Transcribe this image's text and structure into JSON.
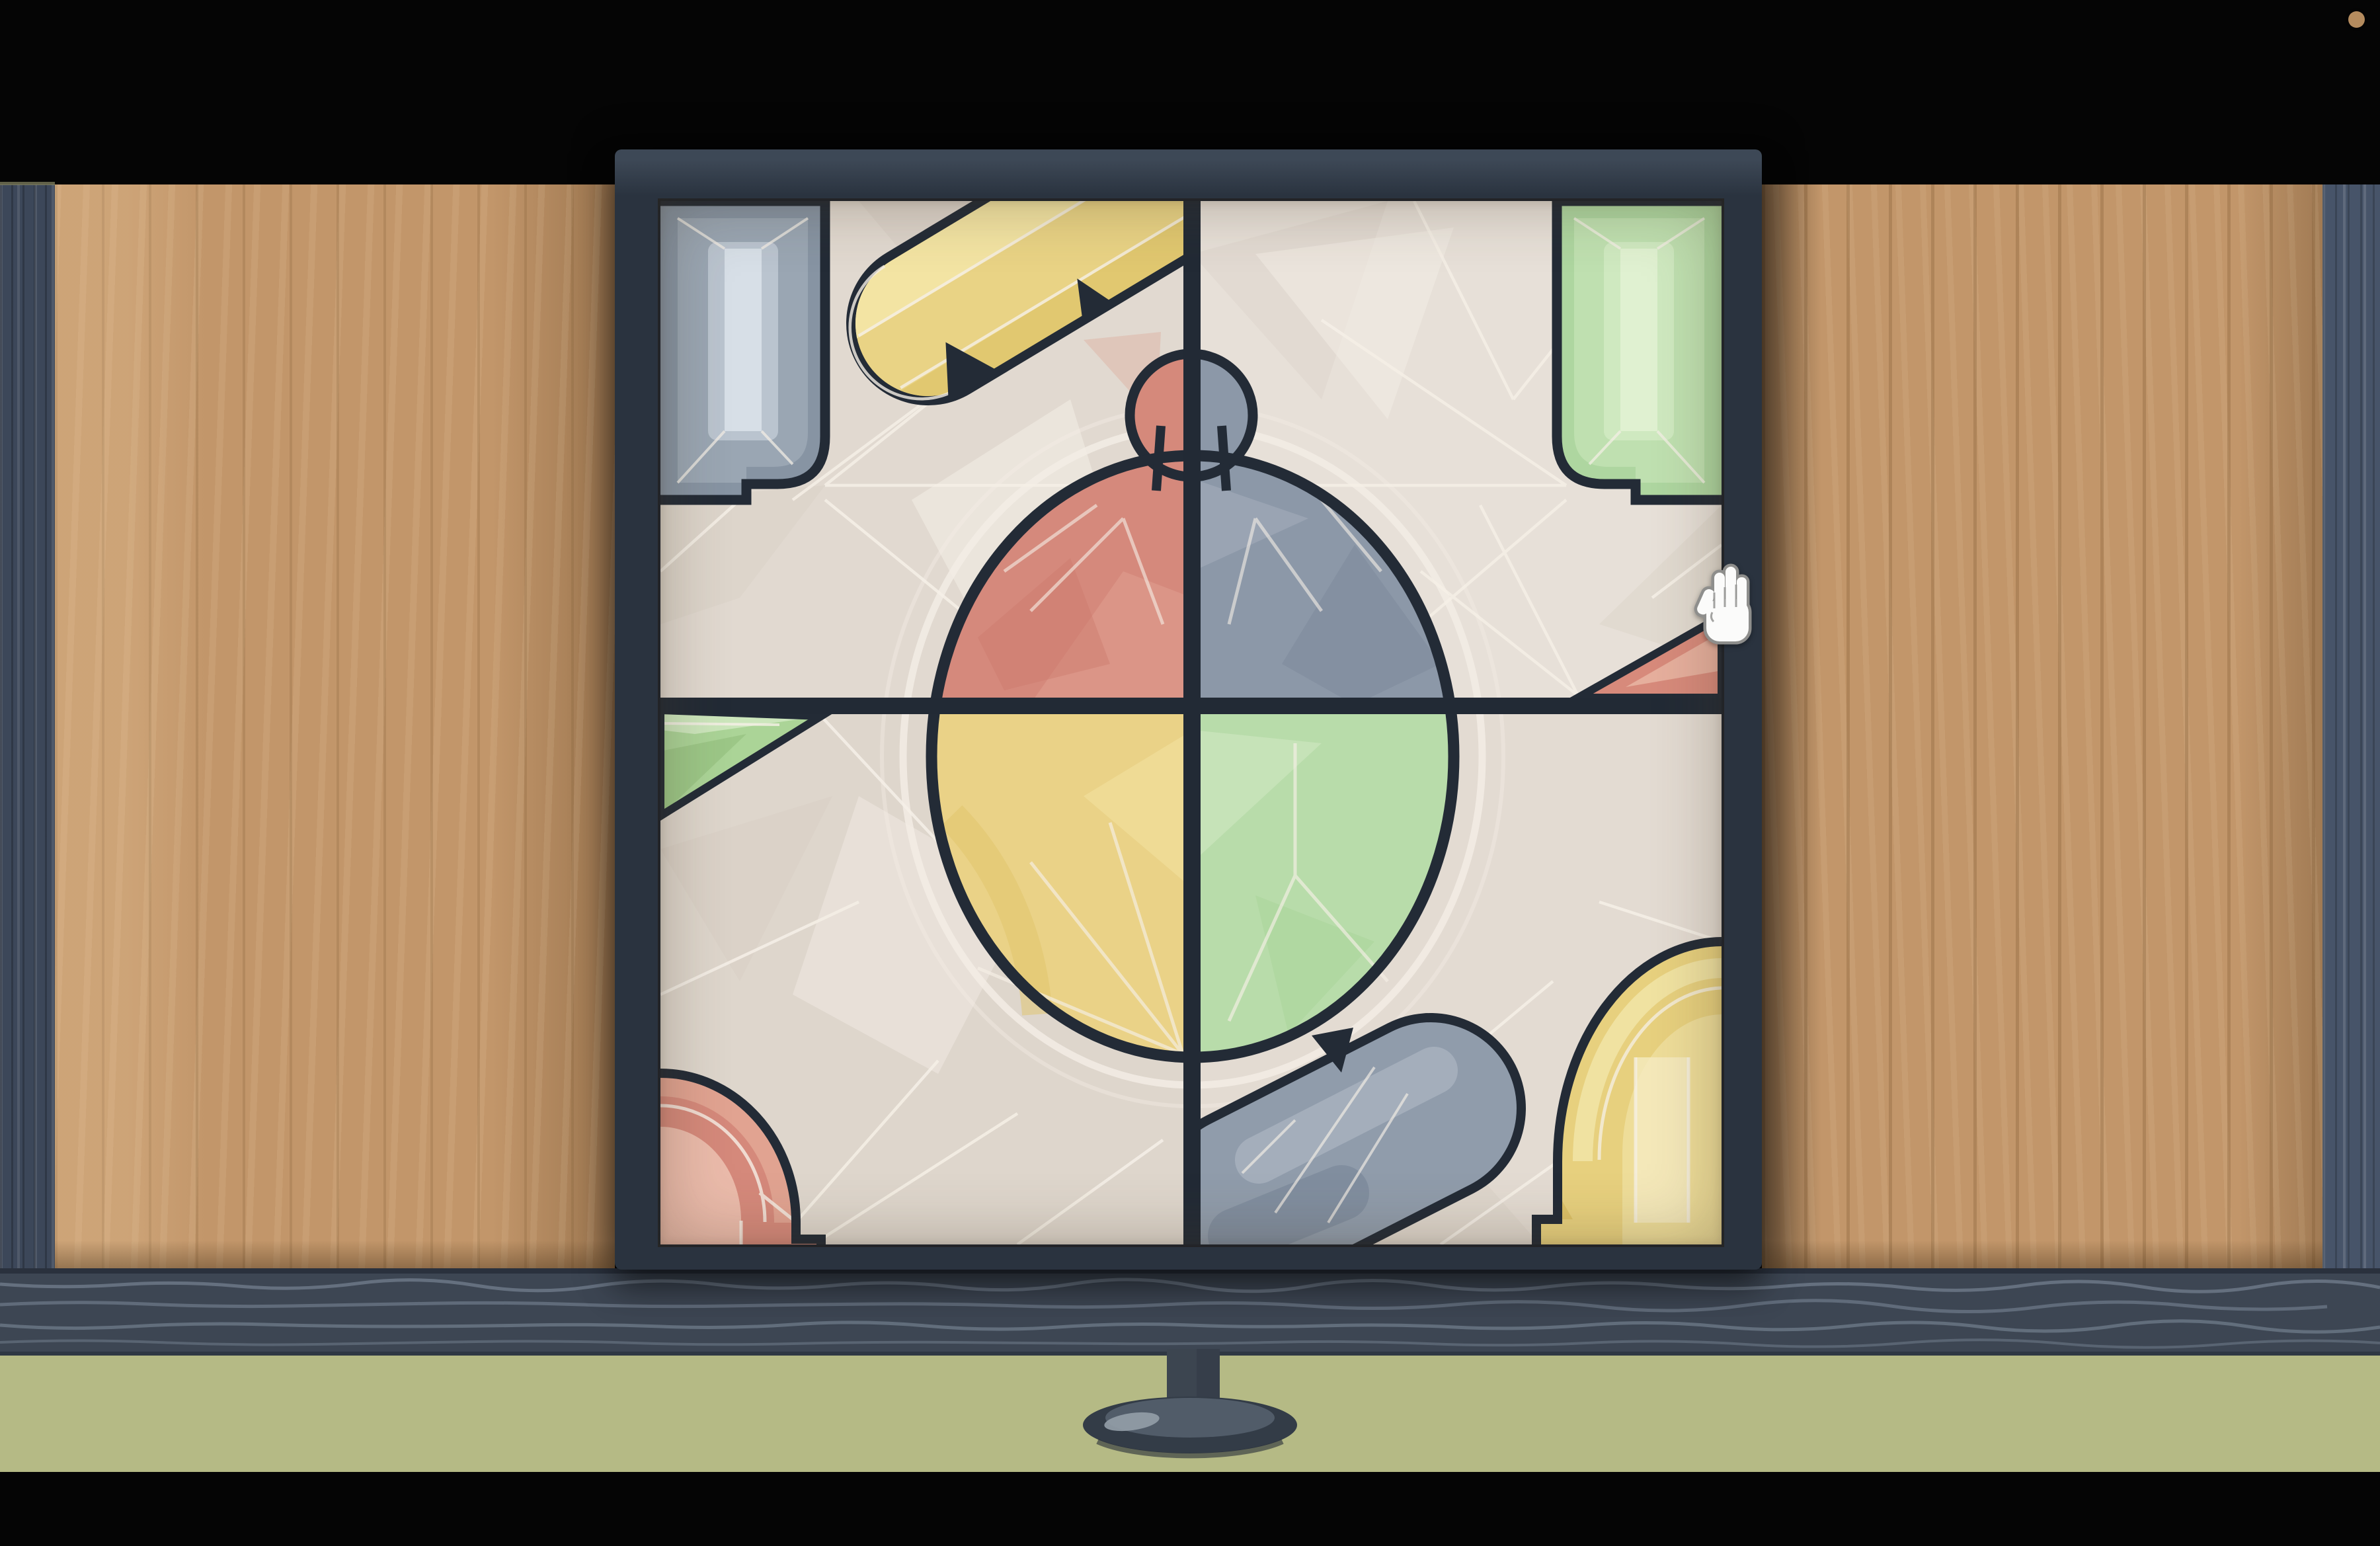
{
  "meta": {
    "app": "puzzle-game",
    "scene": "wooden-cabinet-sliding-panel-stained-glass-puzzle",
    "visible_text": [],
    "cursor": {
      "type": "open-hand",
      "location": "right-frame-edge"
    }
  },
  "colors": {
    "bg_black": "#050505",
    "wall_left": "#3c4759",
    "wall_right": "#475469",
    "wall_accent": "#8a8a66",
    "wood": "#c2966a",
    "table": "#3d4653",
    "table_grain": "#6c7887",
    "table_edge": "#272e39",
    "floor_olive": "#b5ba85",
    "frame": "#2a333f",
    "frame_light": "#3d4856",
    "frame_dark": "#1b222c",
    "bar": "#222a35",
    "outline": "#232b36",
    "bg_tl": "#e1d9d0",
    "bg_tr": "#e7e0d8",
    "bg_bl": "#ded6cc",
    "bg_br": "#e3dbd2",
    "facet_line": "#f6f0e7",
    "facet_light": "#f4eee6",
    "facet_shade": "#cbc1b5",
    "red_q": "#d5897c",
    "red_q_light": "#e2a292",
    "red_q_dark": "#cb7a6c",
    "gray_q": "#8c98a8",
    "gray_q_light": "#aab4c1",
    "gray_q_dark": "#7b8899",
    "yellow_q": "#ead287",
    "yellow_q_light": "#f2e2a1",
    "yellow_q_dark": "#dfc36a",
    "green_q": "#b8dcaa",
    "green_q_light": "#d3eac5",
    "green_q_dark": "#a6d193",
    "gem_gray_1": "#8794a3",
    "gem_gray_2": "#9aa6b3",
    "gem_gray_3": "#bac4cf",
    "gem_gray_4": "#d7dfe7",
    "gem_green_1": "#aed6a0",
    "gem_green_2": "#bfe0b0",
    "gem_green_3": "#cfe9c0",
    "gem_green_4": "#e0f1d1",
    "cap_yellow_1": "#e9d385",
    "cap_yellow_2": "#f3e4a3",
    "cap_yellow_3": "#dfc66c",
    "cap_gray_1": "#909cab",
    "cap_gray_2": "#a9b3c0",
    "cap_gray_3": "#7d8a9b",
    "arch_red_1": "#d5897b",
    "arch_red_2": "#e2a694",
    "arch_red_3": "#eec4b4",
    "arch_yellow_1": "#e7d07e",
    "arch_yellow_2": "#f1e3a5",
    "arch_yellow_3": "#dcc167",
    "arch_yellow_4": "#f5ebc0",
    "wedge_green_1": "#abd497",
    "wedge_green_2": "#cfe8c0",
    "wedge_green_3": "#98c383",
    "tri_red_1": "#d78a7b",
    "tri_red_2": "#e9b5a3",
    "sliver_red": "#dfb6a8",
    "knob_red": "#d5897b",
    "knob_gray": "#8c98a8",
    "ped_dark": "#333c47",
    "ped_mid": "#3c4550",
    "ped_top": "#515c69",
    "ped_hi": "#939ea9",
    "hand_fill": "#fbfbfa",
    "hand_line": "#8e8e8c",
    "dot": "#b48b5e"
  },
  "puzzle": {
    "rows": 2,
    "cols": 2,
    "panels": [
      {
        "id": "top-left",
        "shapes": [
          "gray-gem",
          "yellow-capsule",
          "red-circle-quadrant",
          "red-knob-half"
        ]
      },
      {
        "id": "top-right",
        "shapes": [
          "green-gem",
          "gray-circle-quadrant",
          "gray-knob-half",
          "red-corner-triangle"
        ]
      },
      {
        "id": "bottom-left",
        "shapes": [
          "green-wedge",
          "yellow-circle-quadrant",
          "red-arch"
        ]
      },
      {
        "id": "bottom-right",
        "shapes": [
          "green-circle-quadrant",
          "gray-capsule",
          "yellow-arch"
        ]
      }
    ]
  },
  "scene": {
    "left_wall": "dark blue wall strip",
    "right_wall": "dark blue wall strip",
    "left_wood_panel": "sliding wooden door",
    "right_wood_panel": "sliding wooden door",
    "table_front": "dark wood table edge",
    "floor": "olive green surface",
    "pedestal": "puzzle stand",
    "indicator_dot": "small tan dot, top-right"
  }
}
